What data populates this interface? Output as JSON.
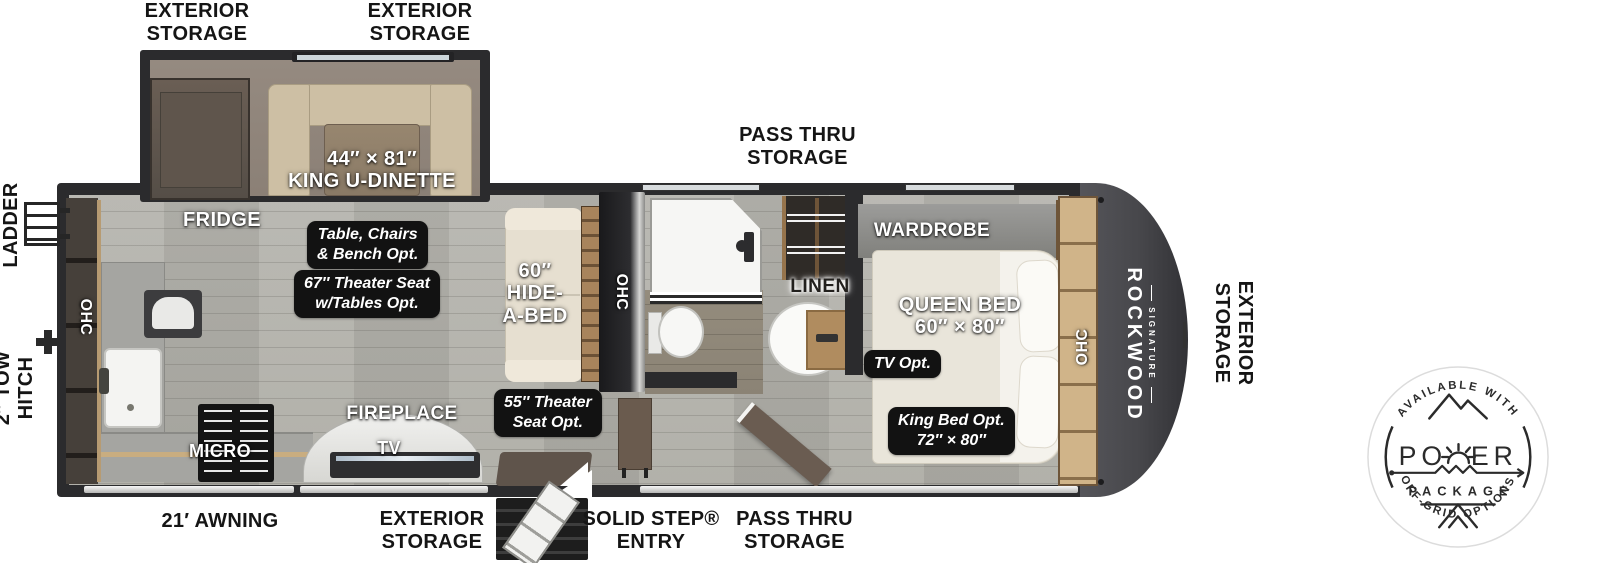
{
  "exterior_labels": {
    "storage_top_left": "EXTERIOR\nSTORAGE",
    "storage_top_mid": "EXTERIOR\nSTORAGE",
    "pass_thru_top": "PASS THRU\nSTORAGE",
    "ladder": "LADDER",
    "tow_hitch": "2″ TOW\nHITCH",
    "storage_right": "EXTERIOR\nSTORAGE",
    "awning": "21′ AWNING",
    "storage_bottom": "EXTERIOR\nSTORAGE",
    "step_entry": "SOLID STEP®\nENTRY",
    "pass_thru_bottom": "PASS THRU\nSTORAGE"
  },
  "interior_labels": {
    "fridge": "FRIDGE",
    "dinette": "44″ × 81″\nKING U-DINETTE",
    "hide_a_bed": "60″\nHIDE-\nA-BED",
    "ohc_kitchen": "OHC",
    "ohc_living": "OHC",
    "ohc_bedroom": "OHC",
    "fireplace": "FIREPLACE",
    "tv": "TV",
    "micro": "MICRO",
    "linen": "LINEN",
    "wardrobe": "WARDROBE",
    "queen_bed": "QUEEN BED\n60″ × 80″"
  },
  "option_labels": {
    "dinette_opt": "Table, Chairs\n& Bench Opt.",
    "theater_67_opt": "67″ Theater Seat\nw/Tables Opt.",
    "theater_55_opt": "55″ Theater\nSeat Opt.",
    "tv_opt": "TV Opt.",
    "king_bed_opt": "King Bed Opt.\n72″ × 80″"
  },
  "branding": {
    "make": "ROCKWOOD",
    "series": "SIGNATURE"
  },
  "badge": {
    "arc_top": "AVAILABLE WITH",
    "word_left": "PO",
    "word_right": "ER",
    "package": "PACKAGE",
    "arc_bottom": "OFF-GRID OPTIONS"
  },
  "colors": {
    "wall": "#2b2b2d",
    "floor": "#b5b4ae",
    "front_cap": "#4a4a4e",
    "cabinet_wood": "#c6a87c",
    "option_label_bg": "#121212"
  }
}
